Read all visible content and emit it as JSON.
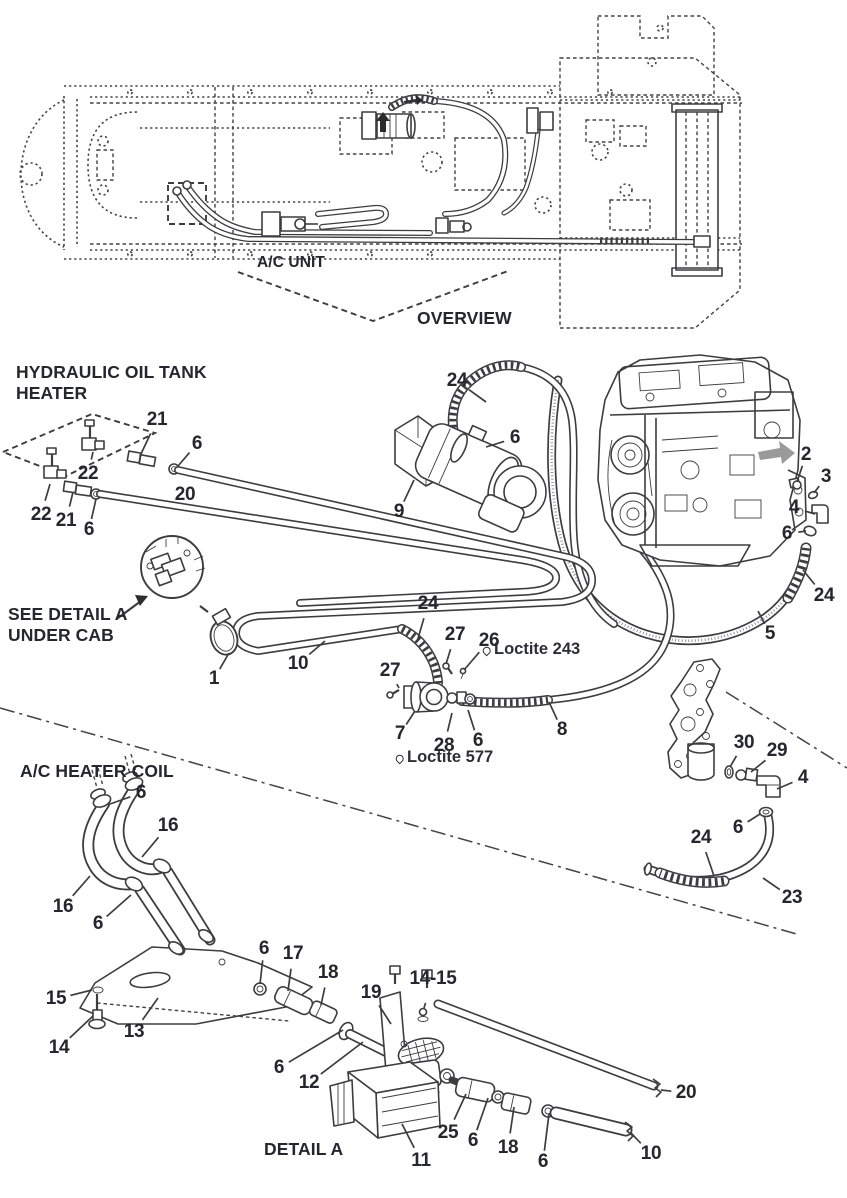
{
  "palette": {
    "ink": "#3d3d40",
    "label": "#26262e",
    "arrow_gray": "#9a9a9a",
    "background": "#ffffff"
  },
  "overview": {
    "ac_unit_label": "A/C UNIT",
    "caption": "OVERVIEW"
  },
  "sections": {
    "hydraulic_heater": {
      "title_line1": "HYDRAULIC OIL TANK",
      "title_line2": "HEATER"
    },
    "see_detail": {
      "line1": "SEE DETAIL A",
      "line2": "UNDER CAB"
    },
    "ac_heater_coil": {
      "title": "A/C HEATER COIL"
    },
    "detail_a": {
      "caption": "DETAIL A"
    }
  },
  "annotations": [
    {
      "icon": "loctite-drop-icon",
      "text": "Loctite 243",
      "x": 482,
      "y": 649
    },
    {
      "icon": "loctite-drop-icon",
      "text": "Loctite 577",
      "x": 395,
      "y": 757
    }
  ],
  "callouts": [
    {
      "n": "21",
      "x": 157,
      "y": 420,
      "tx": 140,
      "ty": 456
    },
    {
      "n": "6",
      "x": 197,
      "y": 444,
      "tx": 178,
      "ty": 466
    },
    {
      "n": "22",
      "x": 88,
      "y": 474,
      "tx": 93,
      "ty": 452
    },
    {
      "n": "22",
      "x": 41,
      "y": 515,
      "tx": 50,
      "ty": 484
    },
    {
      "n": "21",
      "x": 66,
      "y": 521,
      "tx": 73,
      "ty": 492
    },
    {
      "n": "6",
      "x": 89,
      "y": 530,
      "tx": 96,
      "ty": 499
    },
    {
      "n": "20",
      "x": 185,
      "y": 495,
      "tx": 177,
      "ty": 508
    },
    {
      "n": "9",
      "x": 399,
      "y": 512,
      "tx": 414,
      "ty": 480
    },
    {
      "n": "24",
      "x": 457,
      "y": 381,
      "tx": 486,
      "ty": 402
    },
    {
      "n": "6",
      "x": 515,
      "y": 438,
      "tx": 486,
      "ty": 447
    },
    {
      "n": "2",
      "x": 806,
      "y": 455,
      "tx": 797,
      "ty": 482
    },
    {
      "n": "3",
      "x": 826,
      "y": 477,
      "tx": 814,
      "ty": 493
    },
    {
      "n": "4",
      "x": 794,
      "y": 508,
      "tx": 815,
      "ty": 514
    },
    {
      "n": "6",
      "x": 787,
      "y": 534,
      "tx": 806,
      "ty": 531
    },
    {
      "n": "24",
      "x": 824,
      "y": 596,
      "tx": 803,
      "ty": 570
    },
    {
      "n": "5",
      "x": 770,
      "y": 634,
      "tx": 758,
      "ty": 611
    },
    {
      "n": "24",
      "x": 428,
      "y": 604,
      "tx": 417,
      "ty": 642
    },
    {
      "n": "27",
      "x": 455,
      "y": 635,
      "tx": 446,
      "ty": 664
    },
    {
      "n": "26",
      "x": 489,
      "y": 641,
      "tx": 464,
      "ty": 670
    },
    {
      "n": "27",
      "x": 390,
      "y": 671,
      "tx": 399,
      "ty": 688
    },
    {
      "n": "7",
      "x": 400,
      "y": 734,
      "tx": 415,
      "ty": 711
    },
    {
      "n": "28",
      "x": 444,
      "y": 746,
      "tx": 452,
      "ty": 713
    },
    {
      "n": "6",
      "x": 478,
      "y": 741,
      "tx": 468,
      "ty": 710
    },
    {
      "n": "8",
      "x": 562,
      "y": 730,
      "tx": 549,
      "ty": 702
    },
    {
      "n": "30",
      "x": 744,
      "y": 743,
      "tx": 730,
      "ty": 767
    },
    {
      "n": "29",
      "x": 777,
      "y": 751,
      "tx": 751,
      "ty": 772
    },
    {
      "n": "4",
      "x": 803,
      "y": 778,
      "tx": 777,
      "ty": 789
    },
    {
      "n": "6",
      "x": 738,
      "y": 828,
      "tx": 760,
      "ty": 814
    },
    {
      "n": "24",
      "x": 701,
      "y": 838,
      "tx": 714,
      "ty": 876
    },
    {
      "n": "23",
      "x": 792,
      "y": 898,
      "tx": 763,
      "ty": 878
    },
    {
      "n": "1",
      "x": 214,
      "y": 679,
      "tx": 229,
      "ty": 653
    },
    {
      "n": "10",
      "x": 298,
      "y": 664,
      "tx": 325,
      "ty": 641
    },
    {
      "n": "6",
      "x": 141,
      "y": 793,
      "tx": 110,
      "ty": 804
    },
    {
      "n": "16",
      "x": 168,
      "y": 826,
      "tx": 142,
      "ty": 857
    },
    {
      "n": "16",
      "x": 63,
      "y": 907,
      "tx": 90,
      "ty": 876
    },
    {
      "n": "6",
      "x": 98,
      "y": 924,
      "tx": 131,
      "ty": 895
    },
    {
      "n": "15",
      "x": 56,
      "y": 999,
      "tx": 92,
      "ty": 990
    },
    {
      "n": "14",
      "x": 59,
      "y": 1048,
      "tx": 93,
      "ty": 1016
    },
    {
      "n": "13",
      "x": 134,
      "y": 1032,
      "tx": 158,
      "ty": 998
    },
    {
      "n": "6",
      "x": 264,
      "y": 949,
      "tx": 260,
      "ty": 984
    },
    {
      "n": "17",
      "x": 293,
      "y": 954,
      "tx": 288,
      "ty": 991
    },
    {
      "n": "18",
      "x": 328,
      "y": 973,
      "tx": 321,
      "ty": 1005
    },
    {
      "n": "19",
      "x": 371,
      "y": 993,
      "tx": 391,
      "ty": 1024
    },
    {
      "n": "14-15",
      "x": 433,
      "y": 979,
      "tx": 424,
      "ty": 1008
    },
    {
      "n": "6",
      "x": 279,
      "y": 1068,
      "tx": 343,
      "ty": 1030
    },
    {
      "n": "12",
      "x": 309,
      "y": 1083,
      "tx": 363,
      "ty": 1042
    },
    {
      "n": "11",
      "x": 421,
      "y": 1161,
      "tx": 402,
      "ty": 1124
    },
    {
      "n": "25",
      "x": 448,
      "y": 1133,
      "tx": 466,
      "ty": 1094
    },
    {
      "n": "6",
      "x": 473,
      "y": 1141,
      "tx": 488,
      "ty": 1098
    },
    {
      "n": "18",
      "x": 508,
      "y": 1148,
      "tx": 514,
      "ty": 1107
    },
    {
      "n": "6",
      "x": 543,
      "y": 1162,
      "tx": 549,
      "ty": 1114
    },
    {
      "n": "10",
      "x": 651,
      "y": 1154,
      "tx": 631,
      "ty": 1133
    },
    {
      "n": "20",
      "x": 686,
      "y": 1093,
      "tx": 661,
      "ty": 1090
    }
  ]
}
